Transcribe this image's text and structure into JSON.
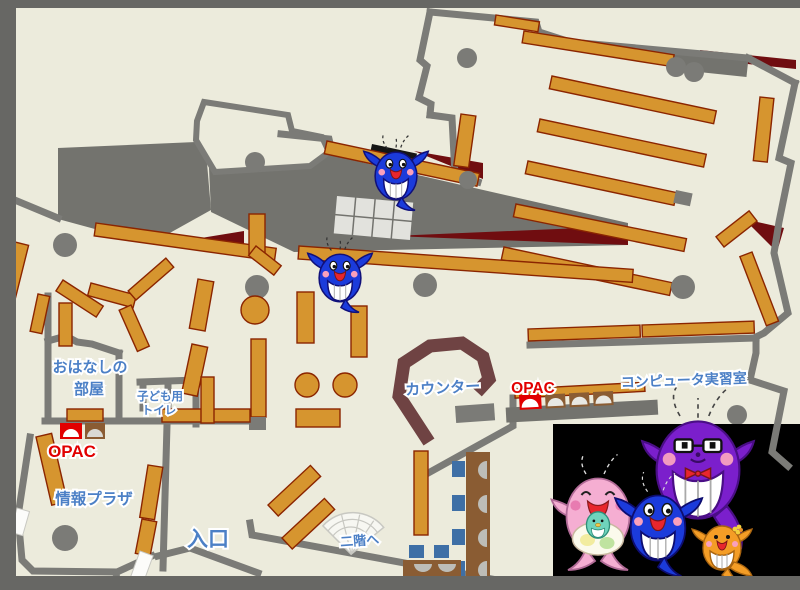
{
  "title": "library-floor-map",
  "labels": {
    "storytelling_room_line1": "おはなしの",
    "storytelling_room_line2": "部屋",
    "kids_toilet_line1": "子ども用",
    "kids_toilet_line2": "トイレ",
    "opac_left": "OPAC",
    "info_plaza": "情報プラザ",
    "entrance": "入口",
    "counter": "カウンター",
    "opac_right": "OPAC",
    "computer_room": "コンピュータ実習室",
    "to_second_floor": "二階へ"
  },
  "colors": {
    "floor": "#ECEBDC",
    "frame": "#676764",
    "wall": "#7B7B77",
    "gray_area": "#73736E",
    "shelf_fill": "#D6952F",
    "shelf_border": "#8B2500",
    "dark_red_area": "#700D10",
    "counter": "#6F4343",
    "chair_blue": "#3E6FA6",
    "desk_brown": "#8A5C33",
    "label_blue": "#4C80C6",
    "opac_red": "#E10000",
    "mascot_blue": "#1B3BDB",
    "mascot_pink": "#F5AED2",
    "mascot_purple": "#7B1FCC",
    "mascot_orange": "#F49D26",
    "mascot_teal": "#6FD3BC"
  },
  "mascots": {
    "on_map": "blue whale mascots",
    "family_photo": [
      "pink whale with baby whale",
      "blue whale child",
      "purple whale with glasses and red bow tie",
      "orange whale with flower"
    ]
  }
}
